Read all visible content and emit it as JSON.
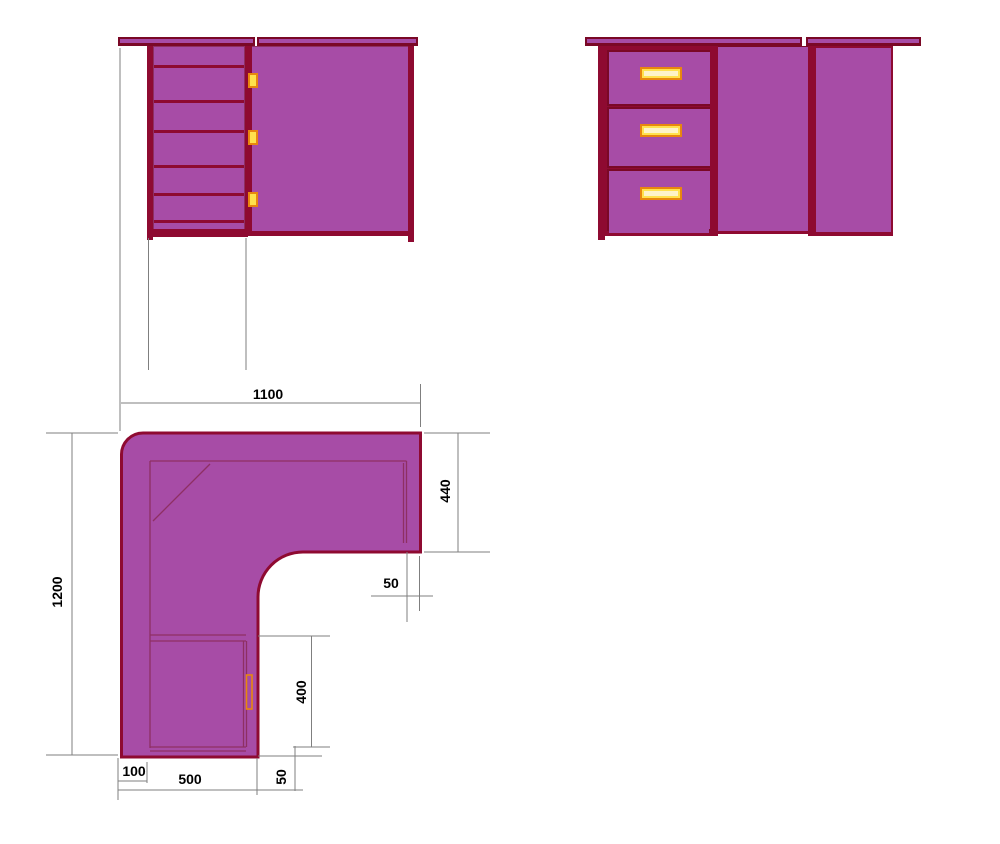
{
  "drawing": {
    "subject": "corner desk orthographic drawing",
    "views": [
      {
        "id": "side-view",
        "label": "side elevation with drawer unit"
      },
      {
        "id": "front-view",
        "label": "front elevation with three drawers"
      },
      {
        "id": "plan-view",
        "label": "top plan of L-shaped desktop"
      }
    ],
    "front_view_drawer_count": 3
  },
  "dimensions": {
    "plan_width_top": "1100",
    "plan_depth_left": "1200",
    "right_wing_depth": "440",
    "right_edge_inset": "50",
    "cabinet_door_width": "400",
    "left_inset": "100",
    "cabinet_width": "500",
    "bottom_edge_inset": "50"
  },
  "colors": {
    "body_fill": "#A74CA6",
    "edge_dark_red": "#8E0A31",
    "edge_darker_red": "#7A0826",
    "inner_line": "#8E2F63",
    "handle_border_orange": "#E8870E",
    "handle_fill_yellow": "#FFE14D",
    "dimension_line_gray": "#7F7F7F",
    "dimension_text": "#000000",
    "background": "#FFFFFF"
  }
}
